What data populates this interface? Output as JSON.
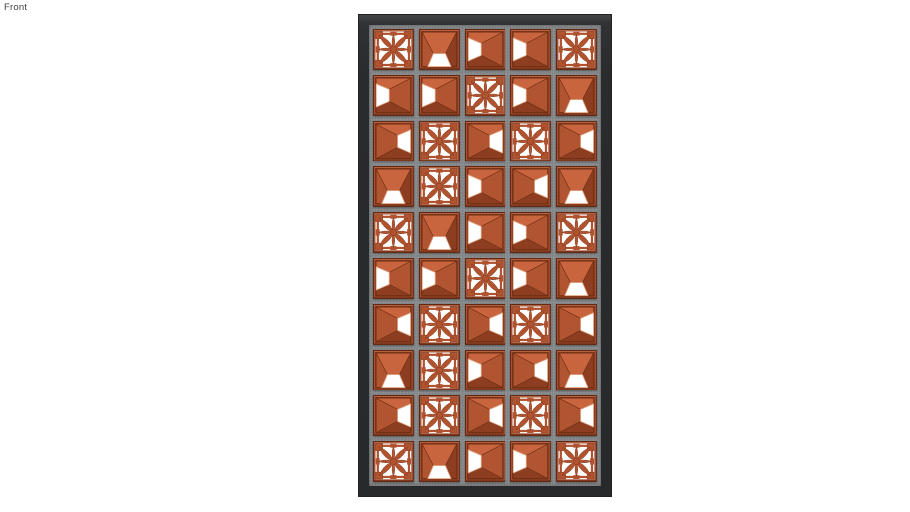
{
  "view_label": "Front",
  "canvas": {
    "background": "#ffffff",
    "label_color": "#3e3e3e"
  },
  "panel": {
    "rows": 10,
    "cols": 5,
    "block_types": {
      "flower": "ornamental-flower-breeze-block",
      "pyr-left": "pyramid-breeze-block-opening-left",
      "pyr-right": "pyramid-breeze-block-opening-right",
      "pyr-bottom": "pyramid-breeze-block-opening-bottom"
    },
    "grid": [
      [
        "flower",
        "pyr-bottom",
        "pyr-left",
        "pyr-left",
        "flower"
      ],
      [
        "pyr-left",
        "pyr-left",
        "flower",
        "pyr-left",
        "pyr-bottom"
      ],
      [
        "pyr-right",
        "flower",
        "pyr-right",
        "flower",
        "pyr-right"
      ],
      [
        "pyr-bottom",
        "flower",
        "pyr-left",
        "pyr-right",
        "pyr-bottom"
      ],
      [
        "flower",
        "pyr-bottom",
        "pyr-left",
        "pyr-left",
        "flower"
      ],
      [
        "pyr-left",
        "pyr-left",
        "flower",
        "pyr-left",
        "pyr-bottom"
      ],
      [
        "pyr-right",
        "flower",
        "pyr-right",
        "flower",
        "pyr-right"
      ],
      [
        "pyr-bottom",
        "flower",
        "pyr-left",
        "pyr-right",
        "pyr-bottom"
      ],
      [
        "pyr-right",
        "flower",
        "pyr-right",
        "flower",
        "pyr-right"
      ],
      [
        "flower",
        "pyr-bottom",
        "pyr-left",
        "pyr-left",
        "flower"
      ]
    ],
    "colors": {
      "frame": "#2a2b2d",
      "frame_highlight": "#47484a",
      "grout": "#888b8d",
      "block_border": "#a85030",
      "block_border_light": "#c06a45",
      "block_border_dark": "#6b2d13",
      "face_light": "#c8653e",
      "face_mid": "#b05431",
      "face_dark": "#8d3d20",
      "cutout": "#ffffff",
      "cutout_edge": "#e2a583",
      "flower_body": "#b2532f",
      "flower_shadow": "#82371b"
    }
  }
}
